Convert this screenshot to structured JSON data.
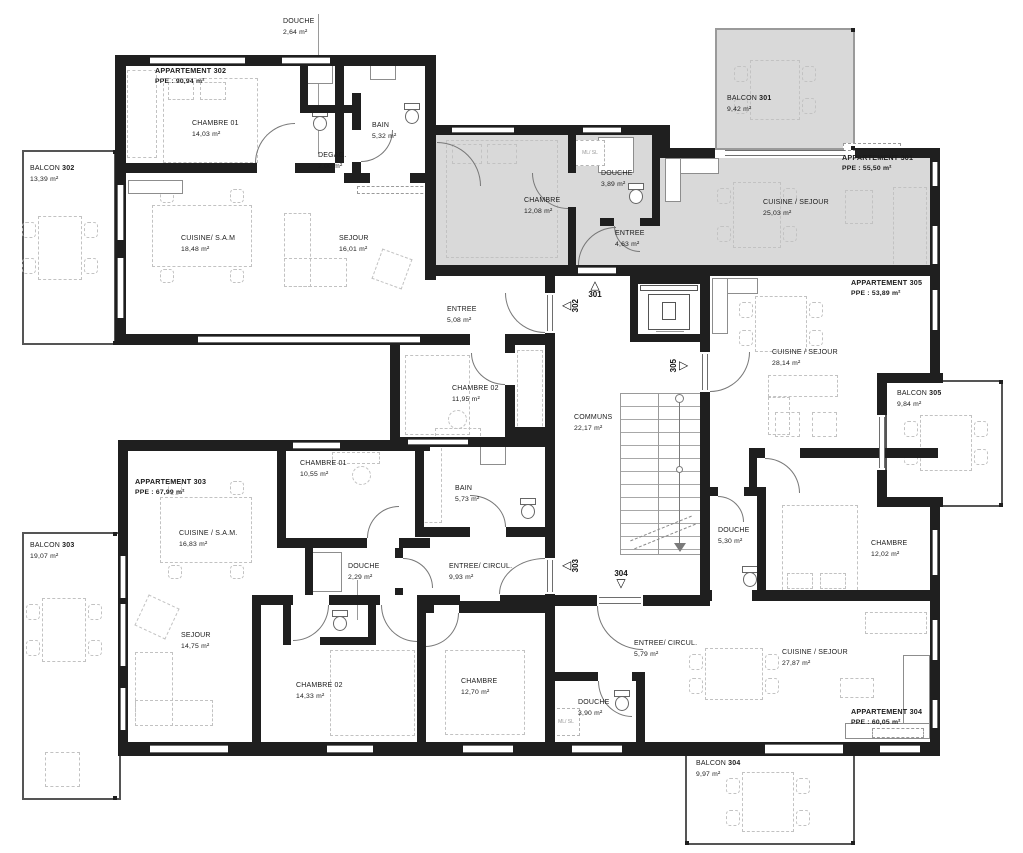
{
  "apartments": [
    {
      "id": "302",
      "title": "APPARTEMENT 302",
      "ppe": "PPE : 90,94 m²",
      "balcony": {
        "label": "BALCON",
        "num": "302",
        "area": "13,39 m²"
      },
      "rooms": [
        {
          "name": "CHAMBRE 01",
          "area": "14,03 m²"
        },
        {
          "name": "BAIN",
          "area": "5,32 m²"
        },
        {
          "name": "DEGAG.",
          "area": "2,00 m²"
        },
        {
          "name": "CUISINE/ S.A.M",
          "area": "18,48 m²"
        },
        {
          "name": "SEJOUR",
          "area": "16,01 m²"
        },
        {
          "name": "ENTREE",
          "area": "5,08 m²"
        },
        {
          "name": "CHAMBRE 02",
          "area": "11,95 m²"
        },
        {
          "name": "DOUCHE",
          "area": "2,64 m²"
        }
      ]
    },
    {
      "id": "301",
      "title": "APPARTEMENT 301",
      "ppe": "PPE : 55,50 m²",
      "highlighted": true,
      "balcony": {
        "label": "BALCON",
        "num": "301",
        "area": "9,42 m²"
      },
      "rooms": [
        {
          "name": "CHAMBRE",
          "area": "12,08 m²"
        },
        {
          "name": "DOUCHE",
          "area": "3,89 m²"
        },
        {
          "name": "ENTREE",
          "area": "4,63 m²"
        },
        {
          "name": "CUISINE / SEJOUR",
          "area": "25,03 m²"
        }
      ]
    },
    {
      "id": "303",
      "title": "APPARTEMENT 303",
      "ppe": "PPE : 67,99 m²",
      "balcony": {
        "label": "BALCON",
        "num": "303",
        "area": "19,07 m²"
      },
      "rooms": [
        {
          "name": "CHAMBRE 01",
          "area": "10,55 m²"
        },
        {
          "name": "BAIN",
          "area": "5,73 m²"
        },
        {
          "name": "CUISINE / S.A.M.",
          "area": "16,83 m²"
        },
        {
          "name": "DOUCHE",
          "area": "2,29 m²"
        },
        {
          "name": "ENTREE/ CIRCUL.",
          "area": "9,93 m²"
        },
        {
          "name": "SEJOUR",
          "area": "14,75 m²"
        },
        {
          "name": "CHAMBRE 02",
          "area": "14,33 m²"
        }
      ]
    },
    {
      "id": "304",
      "title": "APPARTEMENT 304",
      "ppe": "PPE : 60,05 m²",
      "balcony": {
        "label": "BALCON",
        "num": "304",
        "area": "9,97 m²"
      },
      "rooms": [
        {
          "name": "ENTREE/ CIRCUL.",
          "area": "5,79 m²"
        },
        {
          "name": "DOUCHE",
          "area": "3,90 m²"
        },
        {
          "name": "CHAMBRE",
          "area": "12,70 m²"
        },
        {
          "name": "CUISINE / SEJOUR",
          "area": "27,87 m²"
        }
      ]
    },
    {
      "id": "305",
      "title": "APPARTEMENT 305",
      "ppe": "PPE : 53,89 m²",
      "balcony": {
        "label": "BALCON",
        "num": "305",
        "area": "9,84 m²"
      },
      "rooms": [
        {
          "name": "CUISINE / SEJOUR",
          "area": "28,14 m²"
        },
        {
          "name": "DOUCHE",
          "area": "5,30 m²"
        },
        {
          "name": "CHAMBRE",
          "area": "12,02 m²"
        }
      ]
    }
  ],
  "common": {
    "name": "COMMUNS",
    "area": "22,17 m²"
  },
  "door_markers": [
    "301",
    "302",
    "303",
    "304",
    "305"
  ],
  "fixtures": {
    "washer_label": "ML/ SL"
  }
}
